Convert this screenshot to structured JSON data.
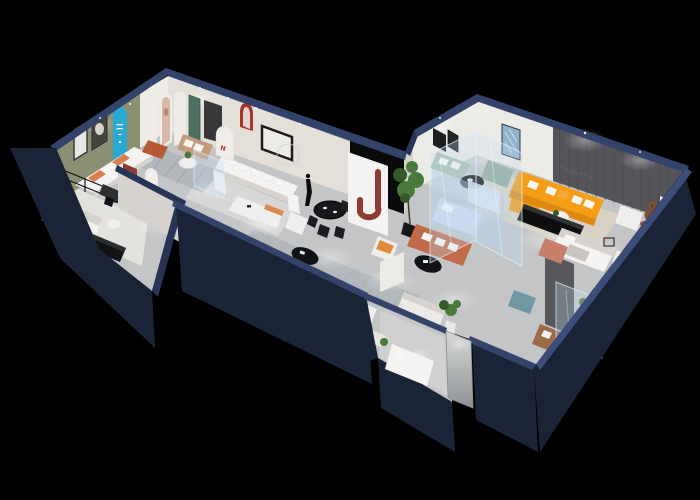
{
  "meta": {
    "description": "3D isometric cutaway render of a furniture showroom floor plan floating on a black background",
    "image_type": "3d-floorplan-render"
  },
  "colors": {
    "bg": "#000000",
    "navyTop": "#34436a",
    "navyTopLight": "#3d4d79",
    "navyMid": "#283455",
    "navySide": "#1b2437",
    "floorBase": "#c4c5c7",
    "floorLight": "#d8d7d6",
    "floorWhite": "#e7e5e2",
    "rugBeige": "#d9d2c4",
    "rugGray": "#b3b8bc",
    "wallWhite": "#edebe6",
    "wallWarm": "#e4e0d9",
    "wallShade": "#d6d3ce",
    "olive": "#8b9073",
    "featureDark": "#55545a",
    "featureSlat": "#47464c",
    "blackOpening": "#0a0a0d",
    "cyan": "#2aa9d2",
    "tealDoor": "#4d7162",
    "maroon": "#8e3b33",
    "crimson": "#a8352b",
    "redLogo": "#c13b2e",
    "orange": "#f49d15",
    "orangeDark": "#dd8a0e",
    "terracotta": "#c06c4b",
    "rust": "#b65a36",
    "tan": "#c49b7e",
    "brown": "#9c6b4a",
    "sage": "#a9bfb0",
    "sageDark": "#93ab9c",
    "blueGlass": "#b9cfe8",
    "blueFurn": "#cddcf2",
    "tealOttoman": "#6f98a5",
    "plantGreen": "#4a7a3a",
    "plantDark": "#35592a",
    "dark": "#141518",
    "white": "#f4f3f1",
    "glassTint": "rgba(195,220,242,0.28)",
    "glassEdge": "rgba(225,240,252,0.7)",
    "salmon": "#c9806a",
    "teddy": "#7d4f33",
    "doorGray": "#b9bcbe"
  },
  "feature_wall": {
    "slogan_line1": "··· ·· ···· ····· ··· ··",
    "slogan_line2": "··· ····"
  },
  "arch_displays": {
    "logo": "N"
  },
  "rooms": [
    {
      "name": "olive-living-room",
      "items": [
        "olive accent wall",
        "two framed artworks",
        "white sofa with orange cushions",
        "black coffee table",
        "potted plant"
      ]
    },
    {
      "name": "arch-gallery-hall",
      "items": [
        "cyan arch panel with small white text",
        "white arch panels",
        "portrait poster arch",
        "teal door",
        "tan loveseat",
        "rust ottoman",
        "round side table",
        "striped rug"
      ]
    },
    {
      "name": "white-lounge",
      "items": [
        "black framed artwork",
        "white u-shaped sectional",
        "white coffee table",
        "orange armchair",
        "white armchair",
        "wire ring decor",
        "mannequin statue",
        "crimson arch niche"
      ]
    },
    {
      "name": "dining-nook",
      "items": [
        "black round dining table",
        "black chairs",
        "dark doorway",
        "white pillar with maroon arch"
      ]
    },
    {
      "name": "front-bedroom-display",
      "items": [
        "metal frame shelf",
        "daybed with orange cushions",
        "black sideboard",
        "round table",
        "brown armchair",
        "writing desk",
        "maroon panel",
        "white arch stand with red logo"
      ]
    },
    {
      "name": "corridor",
      "items": [
        "striped runner rug",
        "black oval coffee table",
        "orange cushion armchair",
        "white sofa",
        "potted plant",
        "white armchair with ottoman"
      ]
    },
    {
      "name": "sage-lounge",
      "items": [
        "sage green sectional",
        "sage chaise",
        "black round coffee table",
        "blue abstract painting",
        "dark framed artworks",
        "glass partition"
      ]
    },
    {
      "name": "glass-bedroom",
      "items": [
        "glass partition walls",
        "light blue bed",
        "light blue shelving",
        "green indoor tree"
      ]
    },
    {
      "name": "orange-living-room",
      "items": [
        "dark slat feature wall with slogan",
        "orange l-shaped sectional",
        "white and orange pillows",
        "white round coffee table",
        "black media console",
        "beige rug",
        "white armchair",
        "teddy bear figure",
        "rust side table",
        "terracotta sofa",
        "black oval coffee table"
      ]
    },
    {
      "name": "bedroom-right",
      "items": [
        "white bed",
        "gray partition wall",
        "teal ottoman",
        "glass corner with cacti",
        "brown sofa",
        "salmon armchair",
        "white nightstand"
      ]
    },
    {
      "name": "entrance",
      "items": [
        "glass entry door panel",
        "white daybed",
        "potted plant"
      ]
    }
  ],
  "lighting": {
    "spotlights": "white ceiling spotlights with glow pools on floors and walls"
  }
}
